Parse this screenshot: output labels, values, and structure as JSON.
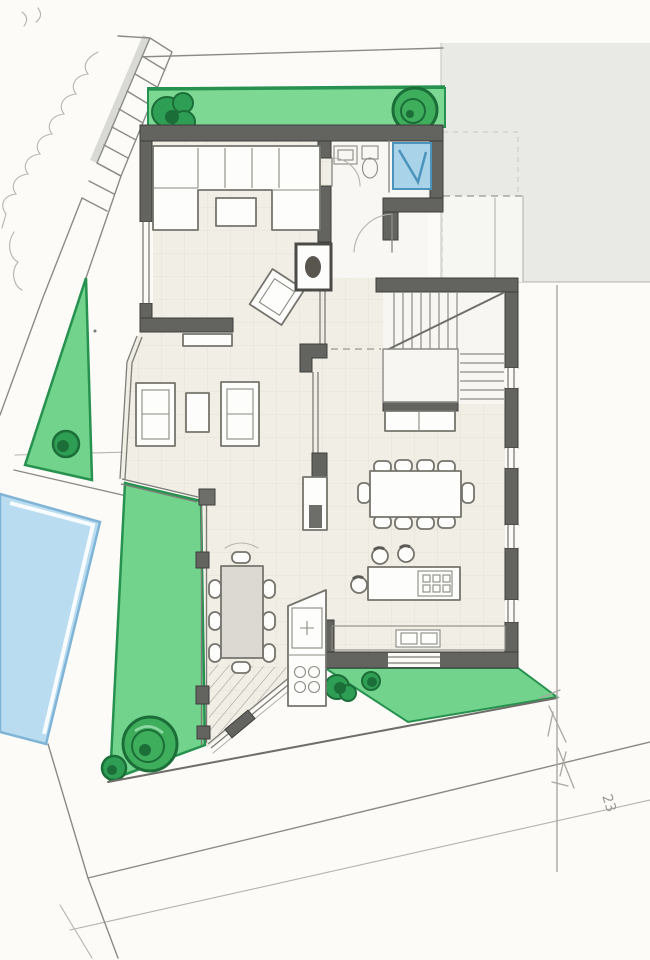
{
  "signature": "23",
  "colors": {
    "paper": "#fcfbf8",
    "wall": "#636360",
    "wall_edge": "#3e3e3c",
    "floor": "#f1eee5",
    "floor_grid": "#e3e0d5",
    "lawn": "#72d48c",
    "lawn_strip": "#7dd893",
    "lawn_edge": "#27914f",
    "bush": "#2f9e55",
    "bush_dark": "#1c6e38",
    "tree": "#3fae5c",
    "pool": "#b9dcf0",
    "pool_edge": "#7fb4d6",
    "shower": "#a9d3e8",
    "shower_line": "#4d94bd",
    "neighbor_block": "#e9e9e6",
    "furniture": "#fdfdfb",
    "table_shade": "#dcd9d2",
    "steps_shadow": "#d9d9d6",
    "signature_ink": "#9a9a94"
  },
  "scene": {
    "kind": "hand-drawn-floor-plan",
    "elements": [
      "site-boundary",
      "street-edge",
      "external-steps",
      "hedge",
      "front-lawn-strip",
      "side-lawn-triangle",
      "garden-lawn",
      "back-lawn",
      "swimming-pool",
      "pool-deck",
      "neighbor-building-block",
      "living-room",
      "u-sofa",
      "coffee-table",
      "lounge-chair",
      "fireplace",
      "sideboard",
      "wc",
      "shower",
      "entry-porch",
      "staircase",
      "armchairs",
      "side-table",
      "media-cabinet",
      "dining-table",
      "kitchen-island",
      "bar-stools",
      "kitchen-counter",
      "veranda-table",
      "trees",
      "bushes",
      "signature"
    ],
    "counts": {
      "dining_chairs": 10,
      "veranda_chairs": 8,
      "bar_stools": 3,
      "armchairs": 2,
      "trees_and_bushes": 7
    }
  }
}
